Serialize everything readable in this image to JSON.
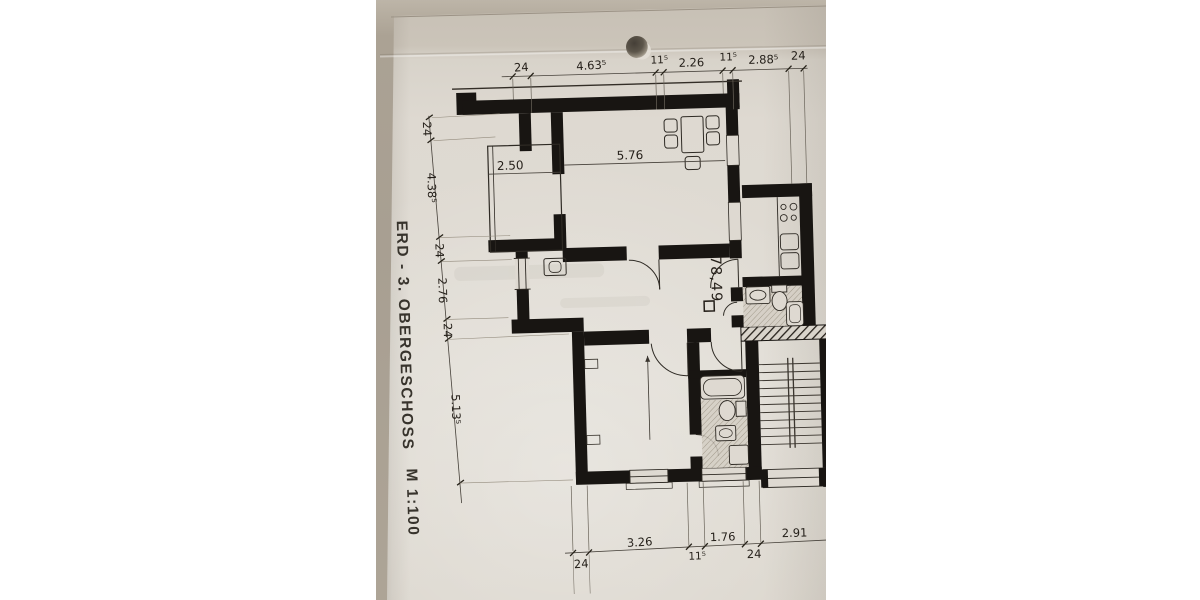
{
  "photo": {
    "title_vertical": "ERD - 3. OBERGESCHOSS",
    "scale": "M 1:100",
    "area_m2": "78,49"
  },
  "dims": {
    "top": [
      "24",
      "4.63⁵",
      "11⁵",
      "2.26",
      "11⁵",
      "2.88⁵",
      "24"
    ],
    "left": [
      "24",
      "4.38⁵",
      "24",
      "2.76",
      "24",
      "5.13⁵"
    ],
    "bottom": [
      "24",
      "3.26",
      "11⁵",
      "1.76",
      "24",
      "2.91"
    ],
    "loggia_width": "2.50",
    "living_width": "5.76"
  },
  "colors": {
    "paper": "#ded9d1",
    "table": "#a89f92",
    "ink": "#181512"
  }
}
